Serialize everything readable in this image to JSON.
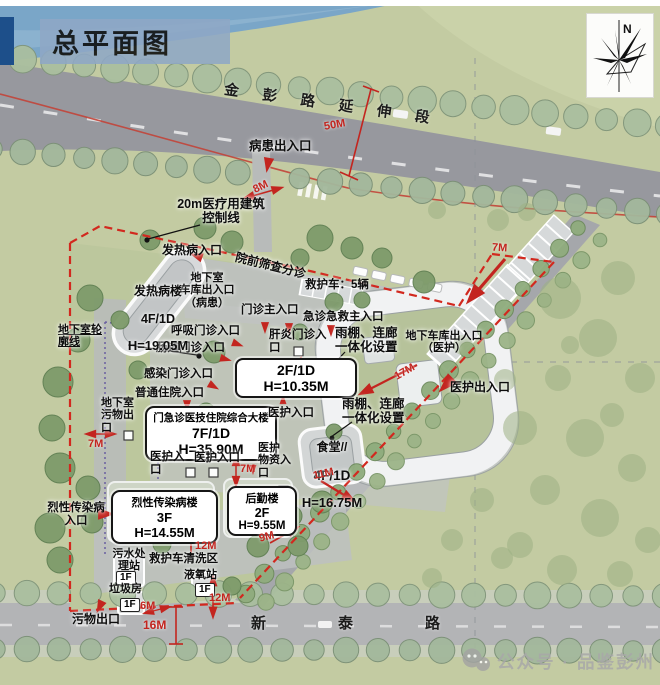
{
  "title": "总平面图",
  "compass": {
    "label": "N"
  },
  "roads": {
    "top": "金彭路延伸段",
    "bottom": "新泰路"
  },
  "buildings": {
    "main": {
      "name": "门急诊医技住院综合大楼",
      "floors": "7F/1D",
      "height": "H=35.90M"
    },
    "wing": {
      "floors": "2F/1D",
      "height": "H=10.35M"
    },
    "fever": {
      "name": "发热病楼",
      "floors": "4F/1D",
      "height": "H=19.05M"
    },
    "canteen": {
      "name": "食堂//",
      "floors": "4F/1D",
      "height": "H=16.75M"
    },
    "infectious": {
      "name": "烈性传染病楼",
      "floors": "3F",
      "height": "H=14.55M"
    },
    "logistics": {
      "name": "后勤楼",
      "floors": "2F",
      "height": "H=9.55M"
    },
    "sewage": {
      "name": "污水处\n理站",
      "floor_tag": "1F"
    },
    "garbage": {
      "name": "垃圾房",
      "floor_tag": "1F"
    },
    "oxygen": {
      "name": "液氧站",
      "floor_tag": "1F"
    }
  },
  "labels": {
    "patient_entrance": "病患出入口",
    "control_line": "20m医疗用建筑\n控制线",
    "pre_triage": "院前筛查分诊",
    "fever_entrance": "发热病入口",
    "basement_garage_patient": "地下室\n车库出入口\n（病患）",
    "ambulance_count": "救护车：5辆",
    "outpatient_main": "门诊主入口",
    "emergency_main": "急诊急救主入口",
    "respiratory": "呼吸门诊入口",
    "intestinal": "肠道门诊入口",
    "hepatitis": "肝炎门诊入口",
    "canopy_1": "雨棚、连廊\n一体化设置",
    "garage_staff": "地下车库出入口\n（医护）",
    "infection": "感染门诊入口",
    "inpatient": "普通住院入口",
    "basement_outline": "地下室轮\n廓线",
    "basement_waste": "地下室\n污物出\n口",
    "staff_entrance_a": "医护入口",
    "staff_entrance_b": "医护入口",
    "staff_entrance_c": "医护入口",
    "canopy_2": "雨棚、连廊\n一体化设置",
    "staff_supplies": "医护\n物资入\n口",
    "infectious_entrance": "烈性传染病\n入口",
    "ambulance_wash": "救护车清洗区",
    "waste_exit": "污物出口",
    "staff_exit": "医护出入口"
  },
  "dimensions": {
    "road_top": "50M",
    "gate": "8M",
    "boundary_ne": "7M",
    "west": "7M",
    "mid": "7M",
    "d17": "17M",
    "d11": "11M",
    "d9": "9M",
    "d12_wash": "12M",
    "d12_oxygen": "12M",
    "d6": "6M",
    "d16": "16M"
  },
  "watermark": {
    "text": "公众号 · 品鉴彭州"
  },
  "colors": {
    "red": "#c3251f",
    "boundary": "#d2281e",
    "title-accent": "#1d4f8a",
    "title-band": "#8fa8c6"
  }
}
